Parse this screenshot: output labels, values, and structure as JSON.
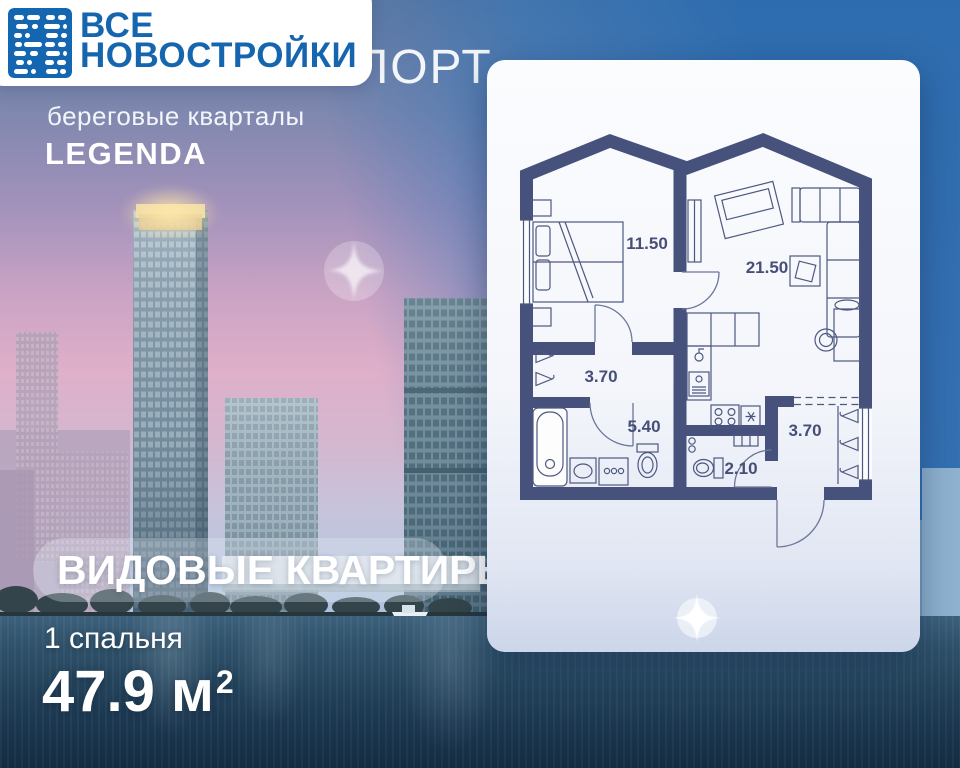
{
  "logo": {
    "line1": "ВСЕ",
    "line2": "НОВОСТРОЙКИ"
  },
  "project": {
    "name": "СЕВЕРНЫЙ ПОРТ",
    "subtitle": "береговые кварталы",
    "developer": "LEGENDA"
  },
  "banner": {
    "title": "ВИДОВЫЕ КВАРТИРЫ"
  },
  "offer": {
    "bedrooms": "1 спальня",
    "area": "47.9 м",
    "area_superscript": "2"
  },
  "floor_plan": {
    "rooms": [
      {
        "name": "bedroom",
        "area": "11.50"
      },
      {
        "name": "living-room-kitchen",
        "area": "21.50"
      },
      {
        "name": "inner-hallway",
        "area": "3.70"
      },
      {
        "name": "bathroom",
        "area": "5.40"
      },
      {
        "name": "wc",
        "area": "2.10"
      },
      {
        "name": "entry-hall",
        "area": "3.70"
      }
    ]
  },
  "colors": {
    "brand_blue": "#1566b0",
    "wall_navy": "#46517c",
    "sky_blue": "#3c7ab5",
    "water_dark": "#1c3a50",
    "crown_glow": "#f3d9a2"
  }
}
